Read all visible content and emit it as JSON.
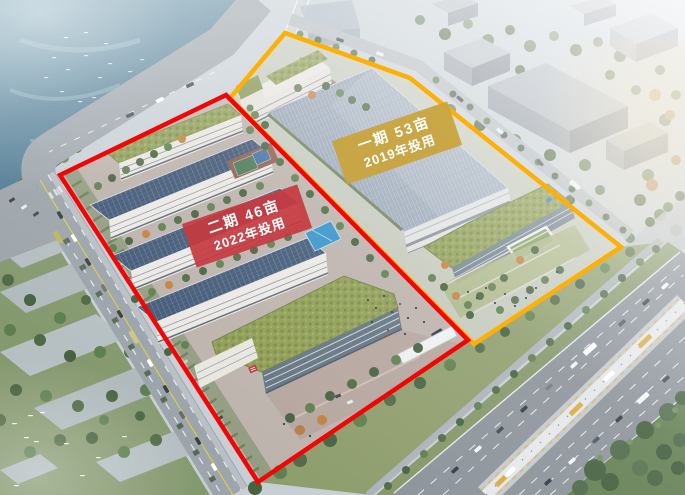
{
  "annotations": {
    "phase1": {
      "label_line1": "一期  53亩",
      "label_line2": "2019年投用",
      "box_color": "rgba(202,163,58,0.92)",
      "outline_color": "#ffb005"
    },
    "phase2": {
      "label_line1": "二期  46亩",
      "label_line2": "2022年投用",
      "box_color": "rgba(199,58,64,0.92)",
      "outline_color": "#f20505"
    }
  },
  "scene_palette": {
    "water": "#4f7d96",
    "pv_roof": "#3d5574",
    "green_roof": "#8a9a4e",
    "highway_asphalt": "#878e96"
  }
}
